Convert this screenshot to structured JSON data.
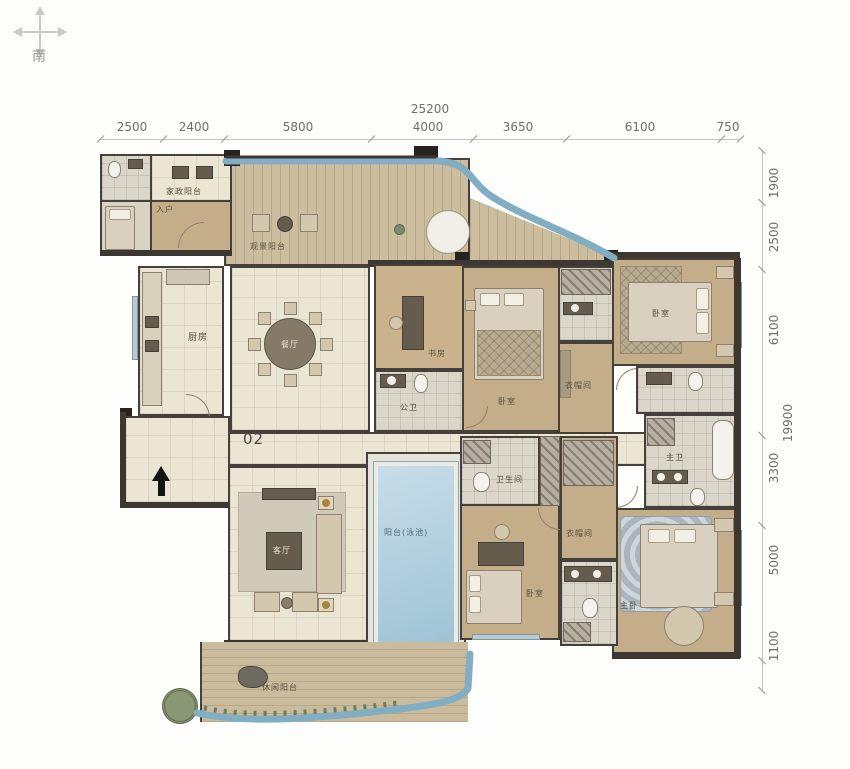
{
  "compass": {
    "south": "南"
  },
  "unit_number": "02",
  "dimensions": {
    "top": {
      "total": "25200",
      "segments": [
        "2500",
        "2400",
        "5800",
        "4000",
        "3650",
        "6100",
        "750"
      ]
    },
    "right": {
      "total": "19900",
      "segments": [
        "1900",
        "2500",
        "6100",
        "3300",
        "5000",
        "1100"
      ]
    }
  },
  "rooms": {
    "entry": "入户",
    "laundry_balcony": "家政阳台",
    "view_balcony": "观景阳台",
    "kitchen": "厨房",
    "dining": "餐厅",
    "study": "书房",
    "public_bath": "公卫",
    "bedroom_mid": "卧室",
    "closet_top": "衣帽间",
    "bedroom_top_right": "卧室",
    "master_bath": "主卫",
    "master_bedroom": "主卧",
    "bedroom_bottom": "卧室",
    "bath_bottom": "卫生间",
    "closet_bottom": "衣帽间",
    "living": "客厅",
    "pool_balcony": "阳台(泳池)",
    "leisure_balcony": "休闲阳台"
  },
  "colors": {
    "wall": "#3c3731",
    "pool_water": "#9fc6d8",
    "water_edge": "#82aec3"
  }
}
